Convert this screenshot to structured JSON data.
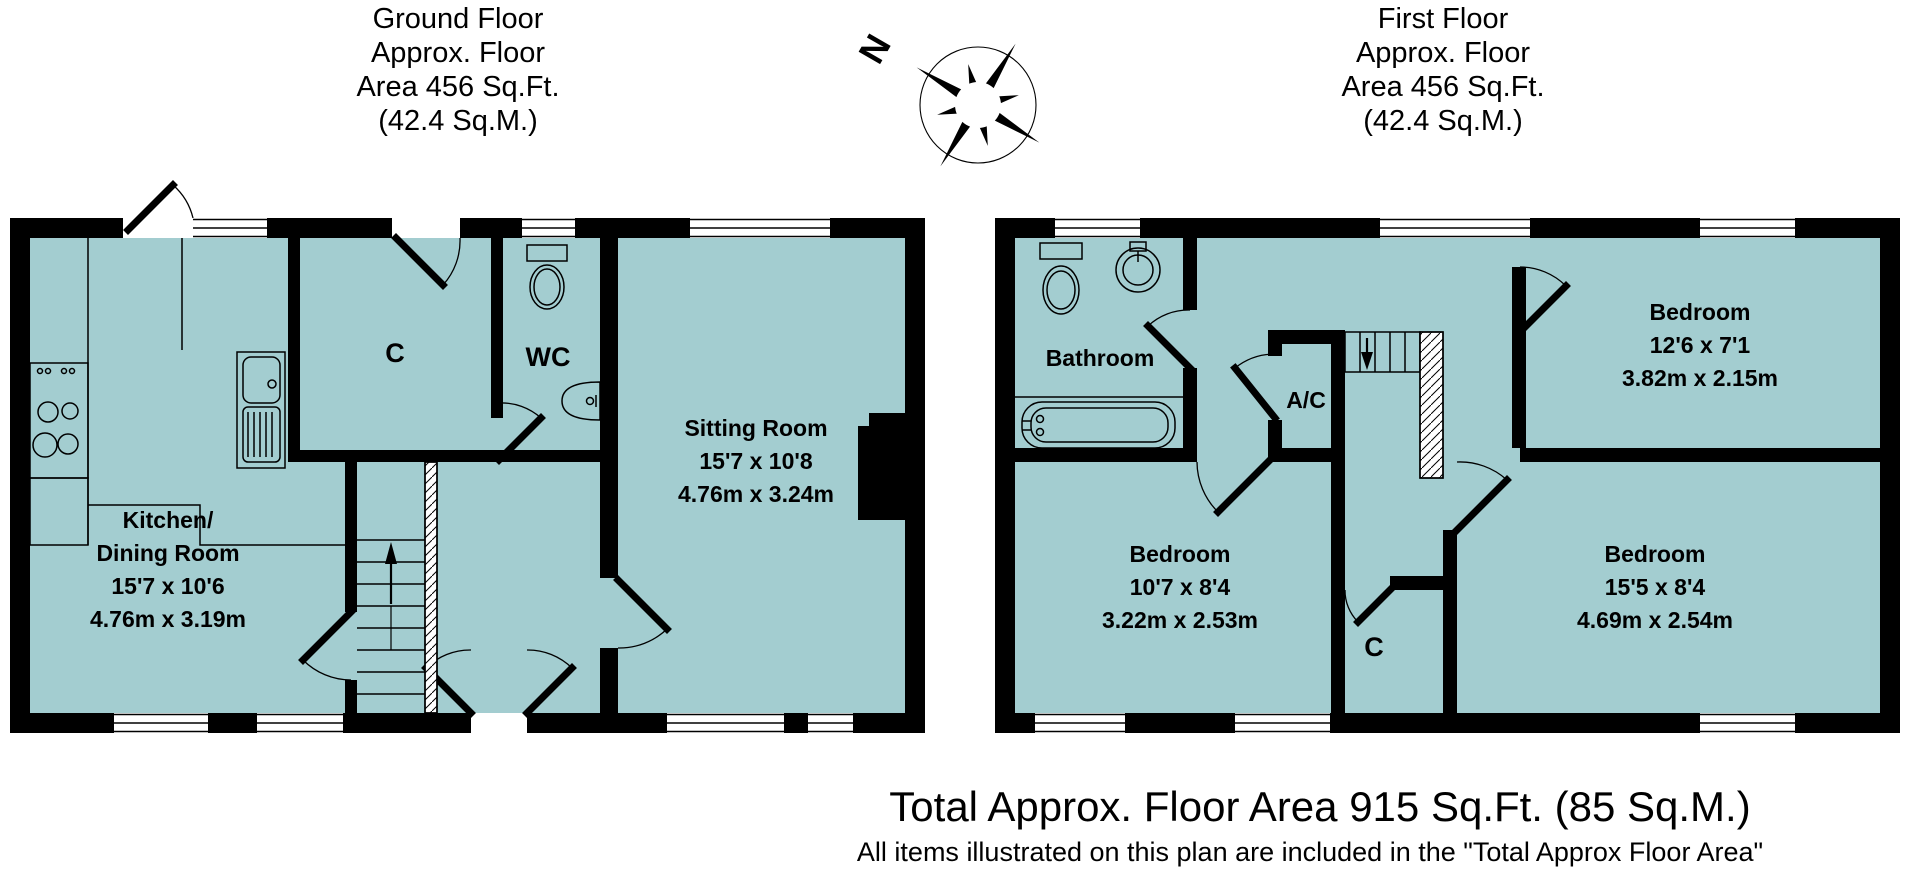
{
  "colors": {
    "plan_fill": "#a3cdd0",
    "wall": "#000000",
    "background": "#ffffff"
  },
  "ground_floor": {
    "header": {
      "line1": "Ground Floor",
      "line2": "Approx. Floor",
      "line3": "Area 456 Sq.Ft.",
      "line4": "(42.4 Sq.M.)"
    },
    "rooms": {
      "kitchen": {
        "line1": "Kitchen/",
        "line2": "Dining Room",
        "imperial": "15'7 x 10'6",
        "metric": "4.76m x 3.19m"
      },
      "sitting": {
        "name": "Sitting Room",
        "imperial": "15'7 x 10'8",
        "metric": "4.76m x 3.24m"
      },
      "cupboard": {
        "name": "C"
      },
      "wc": {
        "name": "WC"
      }
    }
  },
  "first_floor": {
    "header": {
      "line1": "First Floor",
      "line2": "Approx. Floor",
      "line3": "Area 456 Sq.Ft.",
      "line4": "(42.4 Sq.M.)"
    },
    "rooms": {
      "bathroom": {
        "name": "Bathroom"
      },
      "airing_cupboard": {
        "name": "A/C"
      },
      "bedroom_top": {
        "name": "Bedroom",
        "imperial": "12'6 x 7'1",
        "metric": "3.82m x 2.15m"
      },
      "bedroom_left": {
        "name": "Bedroom",
        "imperial": "10'7 x 8'4",
        "metric": "3.22m x 2.53m"
      },
      "bedroom_right": {
        "name": "Bedroom",
        "imperial": "15'5 x 8'4",
        "metric": "4.69m x 2.54m"
      },
      "cupboard": {
        "name": "C"
      }
    }
  },
  "compass": {
    "north_label": "N"
  },
  "footer": {
    "line1": "Total Approx. Floor Area 915 Sq.Ft. (85 Sq.M.)",
    "line2": "All items illustrated on this plan are included in the \"Total Approx Floor Area\""
  }
}
